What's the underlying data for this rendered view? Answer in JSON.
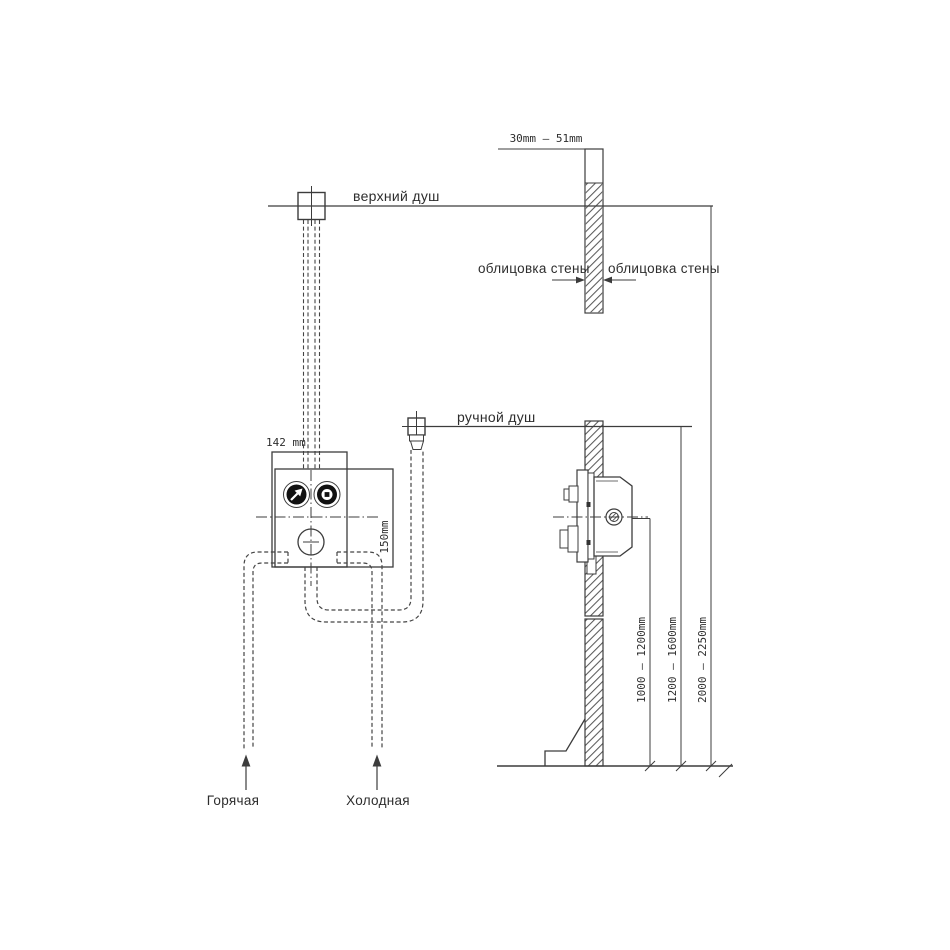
{
  "labels": {
    "overhead_shower": "верхний душ",
    "hand_shower": "ручной душ",
    "wall_cladding_left": "облицовка стены",
    "wall_cladding_right": "облицовка стены",
    "hot_supply": "Горячая",
    "cold_supply": "Холодная"
  },
  "dimensions": {
    "wall_thickness_range": "30mm — 51mm",
    "mixer_body_width": "142 mm",
    "mixer_body_height": "150mm",
    "mixer_mount_height_range": "1000 — 1200mm",
    "hand_shower_mount_height_range": "1200 — 1600mm",
    "overhead_shower_mount_height_range": "2000 — 2250mm"
  },
  "colors": {
    "line": "#3c3c3c",
    "text": "#2d2d2d",
    "hatch": "#5a5a5a",
    "knob_fill": "#111111",
    "background": "#ffffff"
  }
}
